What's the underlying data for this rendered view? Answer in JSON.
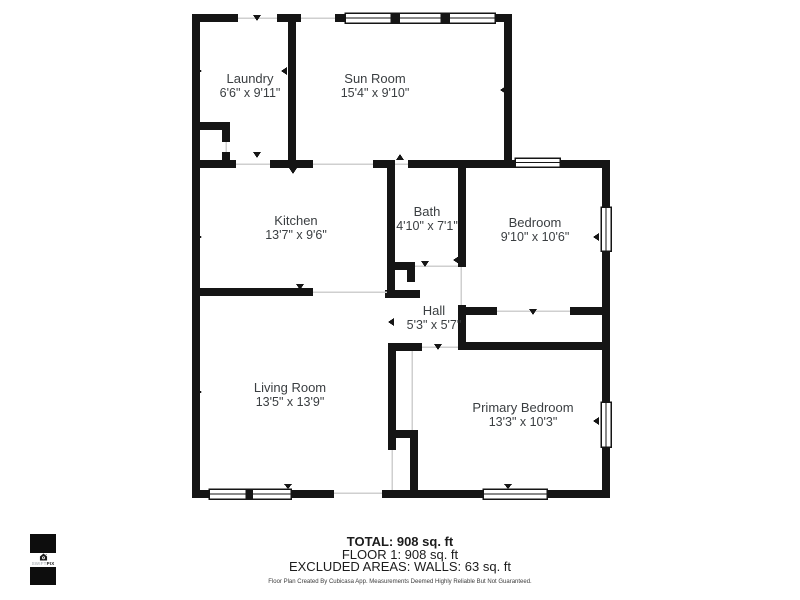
{
  "floorplan": {
    "rooms": [
      {
        "name": "Laundry",
        "dims": "6'6\" x 9'11\""
      },
      {
        "name": "Sun Room",
        "dims": "15'4\" x 9'10\""
      },
      {
        "name": "Kitchen",
        "dims": "13'7\" x 9'6\""
      },
      {
        "name": "Bath",
        "dims": "4'10\" x 7'1\""
      },
      {
        "name": "Bedroom",
        "dims": "9'10\" x 10'6\""
      },
      {
        "name": "Hall",
        "dims": "5'3\" x 5'7\""
      },
      {
        "name": "Living Room",
        "dims": "13'5\" x 13'9\""
      },
      {
        "name": "Primary Bedroom",
        "dims": "13'3\" x 10'3\""
      }
    ],
    "colors": {
      "wall": "#151515",
      "label": "#3a3e41",
      "opening_line": "#cfcfcf"
    }
  },
  "summary": {
    "total_line": "TOTAL: 908 sq. ft",
    "floor_line": "FLOOR 1: 908 sq. ft",
    "excluded_line": "EXCLUDED AREAS: WALLS: 63 sq. ft",
    "disclaimer": "Floor Plan Created By Cubicasa App. Measurements Deemed Highly Reliable But Not Guaranteed."
  },
  "logo": {
    "brand_part1": "SWIFT",
    "brand_part2": "PIX"
  }
}
